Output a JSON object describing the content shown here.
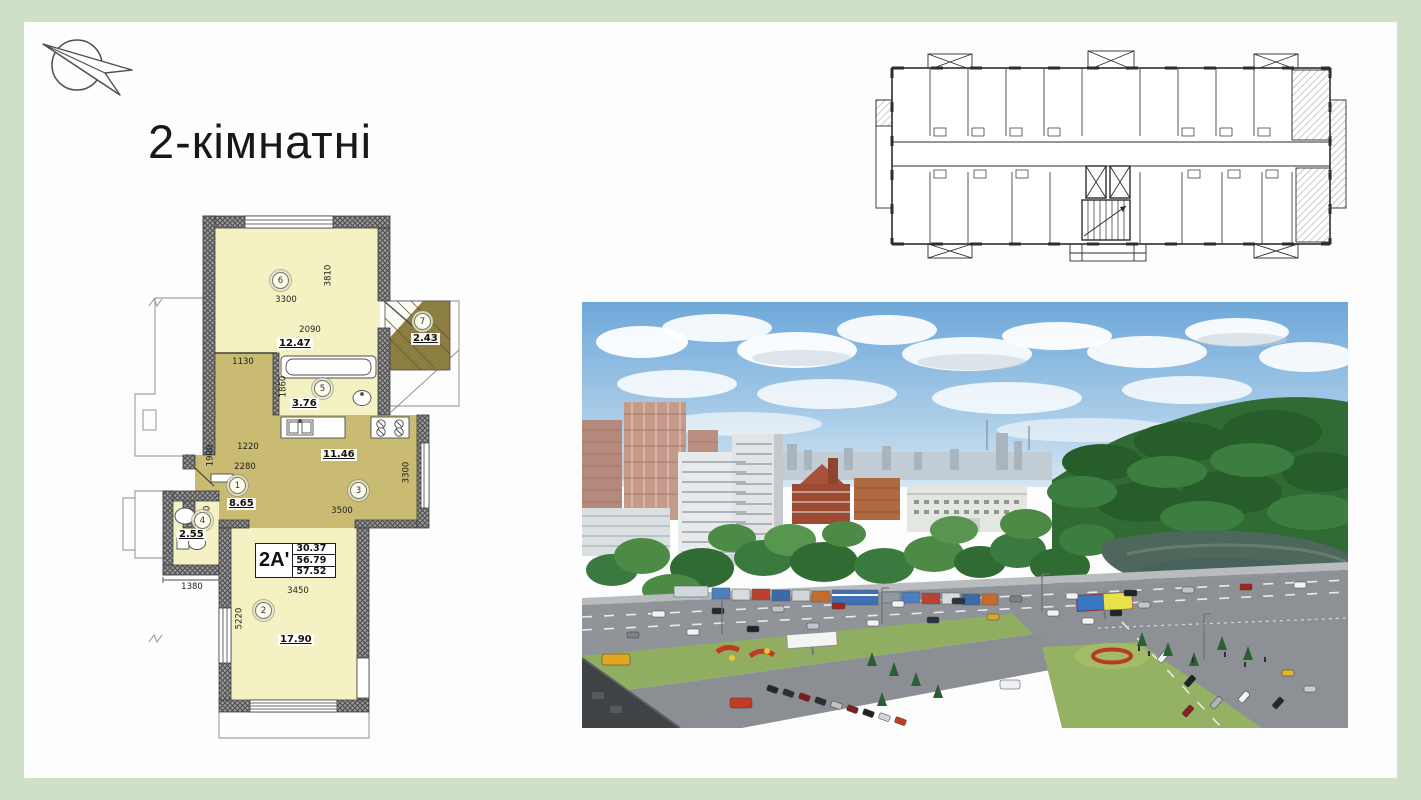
{
  "slide": {
    "title": "2-кімнатні",
    "background": "#cfe0c8",
    "surface": "#fdfdfd"
  },
  "floor_plan": {
    "unit": {
      "label": "2А'",
      "rows": [
        "30.37",
        "56.79",
        "57.52"
      ]
    },
    "rooms": {
      "r1": {
        "num": "1",
        "area": "8.65"
      },
      "r2": {
        "num": "2",
        "area": "17.90"
      },
      "r3": {
        "num": "3",
        "area": "11.46"
      },
      "r4": {
        "num": "4",
        "area": "2.55"
      },
      "r5": {
        "num": "5",
        "area": "3.76"
      },
      "r6": {
        "num": "6",
        "area": "12.47"
      },
      "r7": {
        "num": "7",
        "area": "2.43"
      }
    },
    "dims": {
      "bedroom_h": "3810",
      "bedroom_w": "3300",
      "bedroom_w2": "2090",
      "hall_top": "1130",
      "bath_h": "1860",
      "hall_w1": "1220",
      "hall_w2": "2280",
      "hall_h": "1900",
      "wc_h": "1850",
      "wc_w": "1380",
      "kitchen_w": "3500",
      "kitchen_h": "3300",
      "living_w": "3450",
      "living_h": "5220"
    }
  },
  "palette": {
    "room_light": "#f4f1c3",
    "room_olive": "#c9bc72",
    "balcony_olive": "#8c7e40",
    "wall_gray": "#8d8d8d"
  }
}
